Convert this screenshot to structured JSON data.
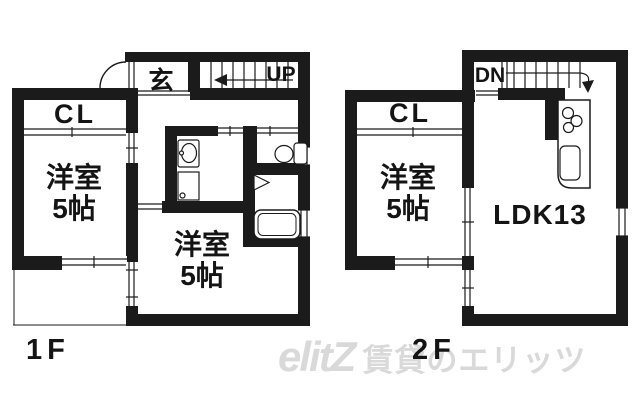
{
  "page": {
    "background_color": "#ffffff",
    "wall_color": "#1b1b1b",
    "watermark_color": "#d9d9d9"
  },
  "floor_1f": {
    "floor_label": "1F",
    "entrance_label": "玄",
    "stairs_label": "UP",
    "closet_label": "CL",
    "bedroom_left": {
      "line1": "洋室",
      "line2": "5帖"
    },
    "bedroom_bottom": {
      "line1": "洋室",
      "line2": "5帖"
    }
  },
  "floor_2f": {
    "floor_label": "2F",
    "stairs_label": "DN",
    "closet_label": "CL",
    "bedroom": {
      "line1": "洋室",
      "line2": "5帖"
    },
    "ldk_label": "LDK13"
  },
  "watermark": {
    "logo_text": "elitZ",
    "brand_text": "賃貸のエリッツ"
  },
  "icons": {
    "fixtures_1f": [
      "door-swing-arc-icon",
      "up-arrow-icon",
      "washbasin-icon",
      "washing-machine-icon",
      "toilet-icon",
      "bath-door-icon",
      "bathtub-icon"
    ],
    "fixtures_2f": [
      "down-arrow-icon",
      "kitchen-counter",
      "stove-burners-icon",
      "kitchen-sink-icon"
    ]
  }
}
